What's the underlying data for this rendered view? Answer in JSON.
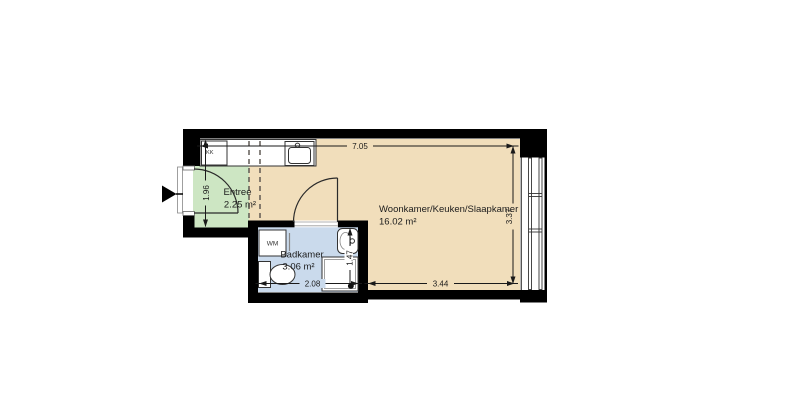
{
  "plan": {
    "rooms": [
      {
        "name": "Entree",
        "area": "2.25 m²"
      },
      {
        "name": "Woonkamer/Keuken/Slaapkamer",
        "area": "16.02 m²"
      },
      {
        "name": "Badkamer",
        "area": "3.06 m²"
      }
    ],
    "labels": {
      "kitchen_unit": "KK",
      "washing_machine": "WM"
    },
    "dimensions": {
      "top_width": "7.05",
      "entree_depth": "1.96",
      "right_depth": "3.37",
      "bottom_width": "3.44",
      "badkamer_width": "2.08",
      "badkamer_depth": "1.47"
    },
    "colors": {
      "wall": "#000000",
      "entree_floor": "#cde6c3",
      "living_floor": "#f1debb",
      "badkamer_floor": "#cadaec"
    }
  }
}
